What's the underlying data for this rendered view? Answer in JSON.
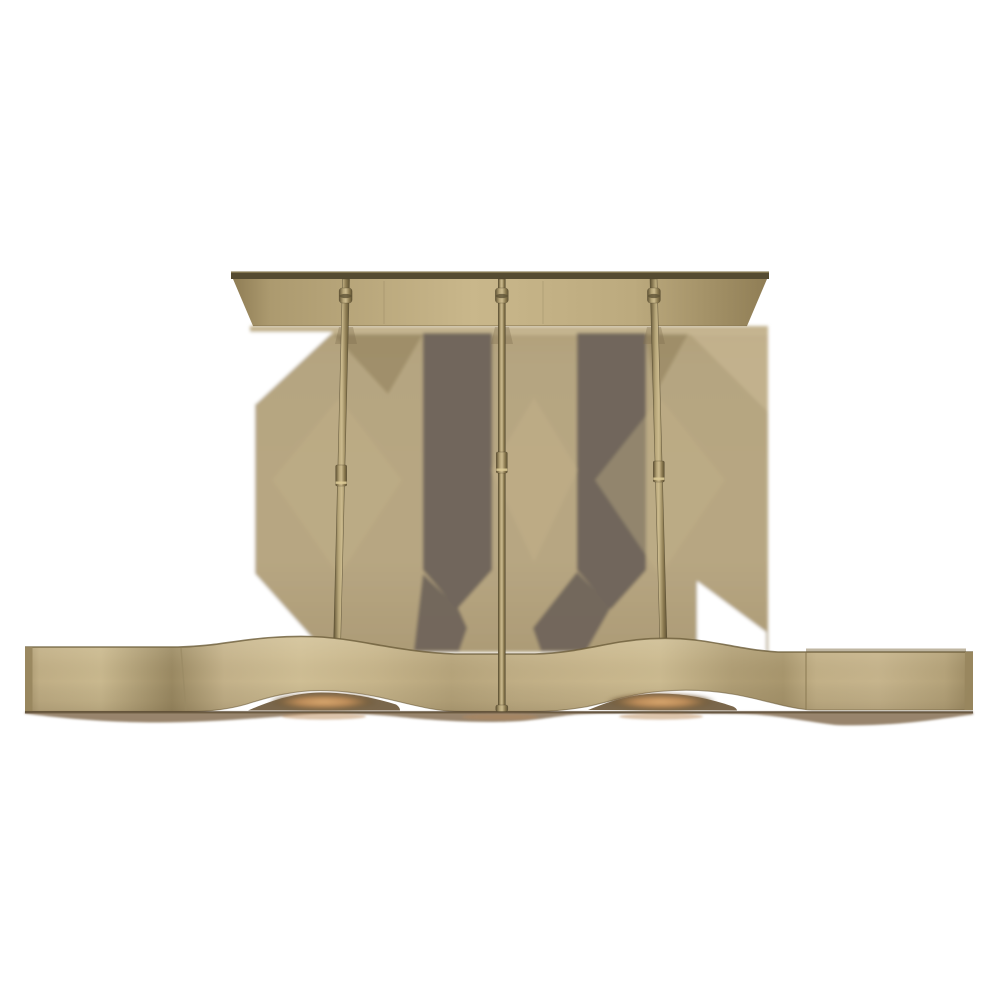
{
  "meta": {
    "content_type": "product-photo",
    "subject": "brass-linear-wave-chandelier",
    "background": "plain white"
  },
  "scene": {
    "stem_count": 3,
    "lit_lamp_glows_visible": 2,
    "parts": {
      "canopy": "ceiling-canopy-bar",
      "stem_left": "left-stem",
      "stem_center": "center-stem",
      "stem_right": "right-stem",
      "shade": "wave-ribbon-shade",
      "shadow_backdrop": "soft-cast-shadow-polygons"
    }
  },
  "colors": {
    "white": "#ffffff",
    "canopy_bar_dark": "#554b31",
    "canopy_bar_highlight": "#8d8059",
    "canopy_face_center": "#c9b78b",
    "canopy_face_edge": "#8f7d55",
    "rod_light": "#ccbb8e",
    "rod_dark": "#5f5233",
    "rod_outline": "#4c4129",
    "collar_ring": "#5e5236",
    "coupler_highlight": "#dcca96",
    "shadow_tan": "#b3a17b",
    "shadow_tan_light": "#c7b691",
    "shadow_tan_deep": "#8e7d5a",
    "shadow_bar": "#6e635a",
    "wave_light": "#cfbe94",
    "wave_mid": "#c0ae85",
    "wave_deep": "#9a8962",
    "wave_edge_line": "#6b5d3a",
    "end_cap": "#98865e",
    "opening_dark": "#6b5739",
    "glow_core": "#dcab72",
    "glow_mid": "#bf8e5a",
    "back_line": "#453a27",
    "under_shadow": "#7a6244",
    "under_amber": "#b98a58"
  }
}
